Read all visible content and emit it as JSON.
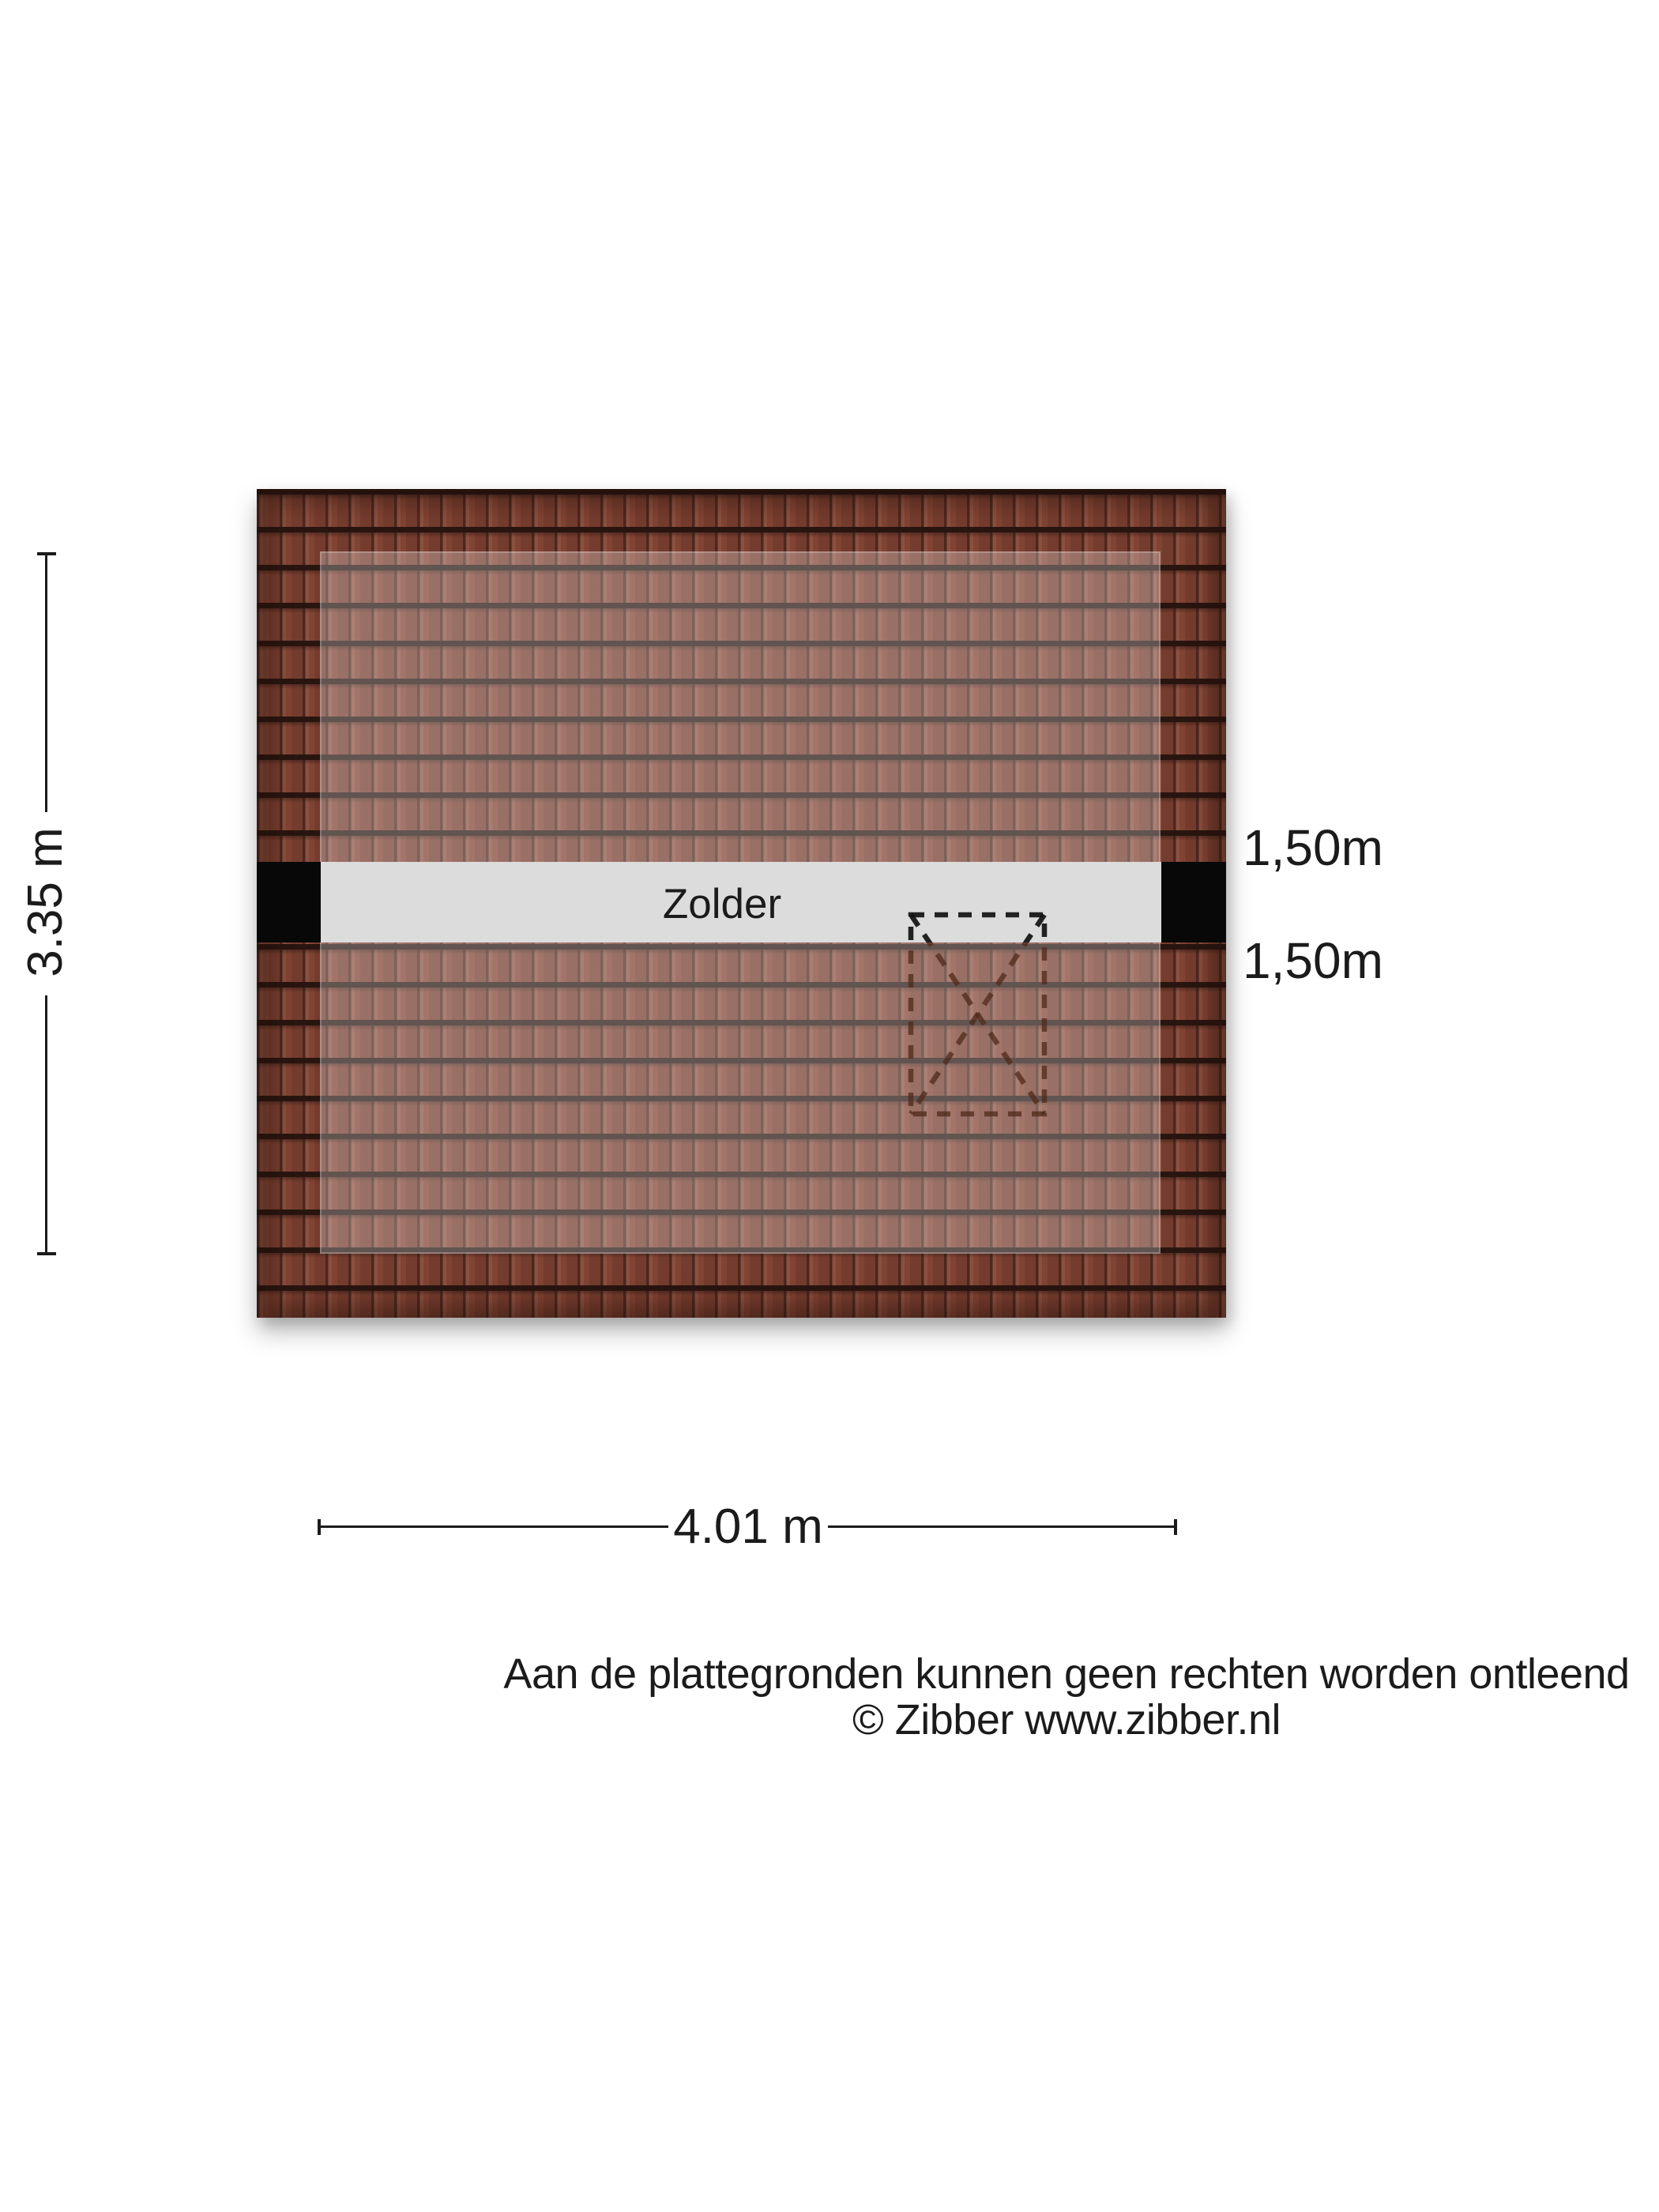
{
  "floorplan": {
    "room_label": "Zolder",
    "headroom_top": "1,50m",
    "headroom_bottom": "1,50m",
    "width_dimension": "4.01 m",
    "height_dimension": "3.35 m"
  },
  "footer": {
    "disclaimer": "Aan de plattegronden kunnen geen rechten worden ontleend",
    "copyright": "© Zibber www.zibber.nl"
  },
  "colors": {
    "roof-base": "#814333",
    "roof-line": "#291510",
    "band": "#dcdcdc",
    "block": "#080808",
    "text": "#1b1b1b",
    "dash-black": "#111111",
    "dash-brown": "#4f2a1a",
    "page-bg": "#ffffff"
  }
}
